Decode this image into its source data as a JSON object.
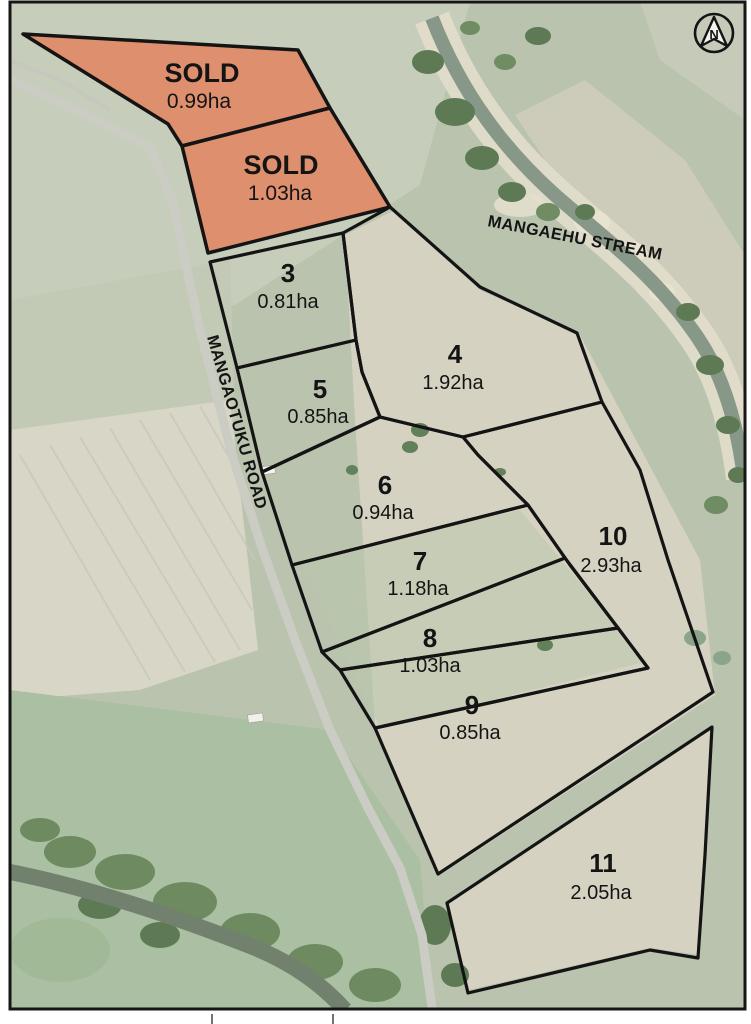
{
  "north_label": "N",
  "stream_label": "MANGAEHU STREAM",
  "road_label": "MANGAOTUKU ROAD",
  "lots": [
    {
      "name": "SOLD",
      "area": "0.99ha",
      "status": "sold"
    },
    {
      "name": "SOLD",
      "area": "1.03ha",
      "status": "sold"
    },
    {
      "name": "3",
      "area": "0.81ha",
      "status": "available"
    },
    {
      "name": "4",
      "area": "1.92ha",
      "status": "available"
    },
    {
      "name": "5",
      "area": "0.85ha",
      "status": "available"
    },
    {
      "name": "6",
      "area": "0.94ha",
      "status": "available"
    },
    {
      "name": "7",
      "area": "1.18ha",
      "status": "available"
    },
    {
      "name": "8",
      "area": "1.03ha",
      "status": "available"
    },
    {
      "name": "9",
      "area": "0.85ha",
      "status": "available"
    },
    {
      "name": "10",
      "area": "2.93ha",
      "status": "available"
    },
    {
      "name": "11",
      "area": "2.05ha",
      "status": "available"
    }
  ],
  "colors": {
    "sold_fill": "#DF8A68",
    "boundary": "#141414",
    "pasture": "#b9c3ae",
    "paddock_tan": "#d6d2c1"
  }
}
